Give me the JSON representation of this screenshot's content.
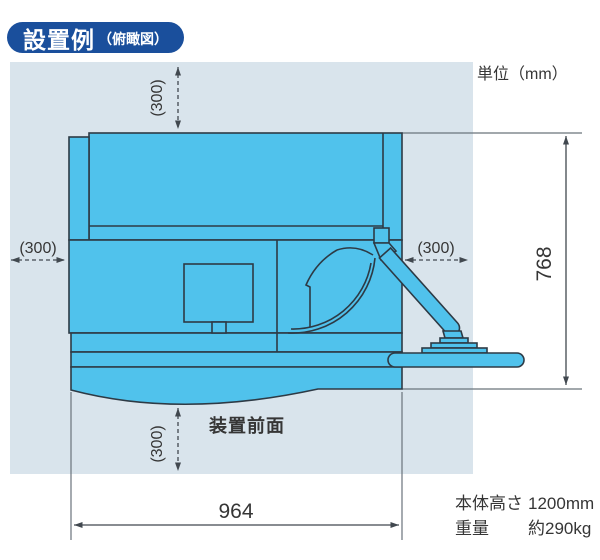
{
  "badge": {
    "title": "設置例",
    "subtitle": "（俯瞰図）"
  },
  "unit_label": "単位（mm）",
  "front_label": "装置前面",
  "dimensions": {
    "top_clearance": "(300)",
    "left_clearance": "(300)",
    "right_clearance": "(300)",
    "front_clearance": "(300)",
    "body_width": "964",
    "body_depth": "768"
  },
  "specs": [
    {
      "label": "本体高さ",
      "value": "1200mm"
    },
    {
      "label": "重量",
      "value": "約290kg"
    }
  ],
  "colors": {
    "badge_bg": "#1a4f9c",
    "badge_text": "#ffffff",
    "panel_bg": "#d9e4ec",
    "machine_fill": "#50c2ec",
    "machine_line": "#2d3a45",
    "dim_line": "#41484f",
    "ext_line": "#6a737b",
    "text": "#363636"
  }
}
